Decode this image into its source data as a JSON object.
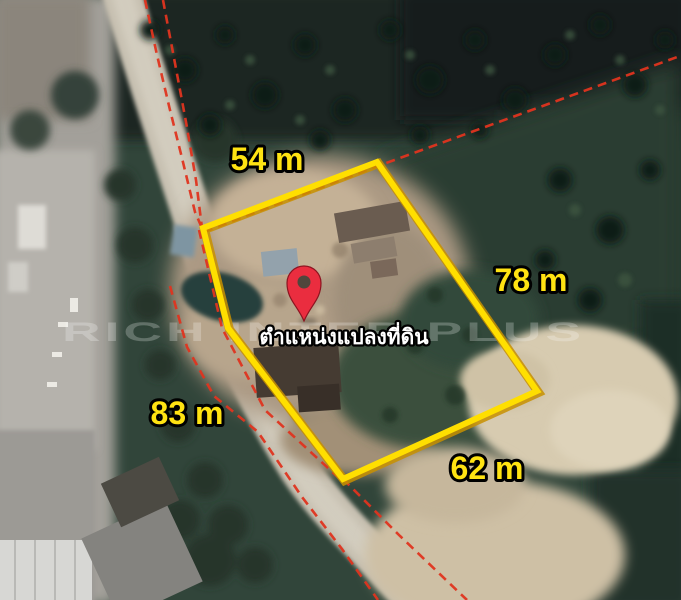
{
  "map": {
    "watermark": "RICH INTER PLUS",
    "pin_label": "ตำแหน่งแปลงที่ดิน",
    "measurements": {
      "top": "54 m",
      "right": "78 m",
      "left": "83 m",
      "bottom": "62 m"
    },
    "colors": {
      "plot_outline": "#ffdf00",
      "plot_outline_shadow": "#c89000",
      "boundary_line": "#e0341f",
      "pin": "#ea2d3f",
      "pin_hole": "#50463c",
      "label_text": "#ffe312",
      "pin_label_text": "#ffffff"
    }
  }
}
